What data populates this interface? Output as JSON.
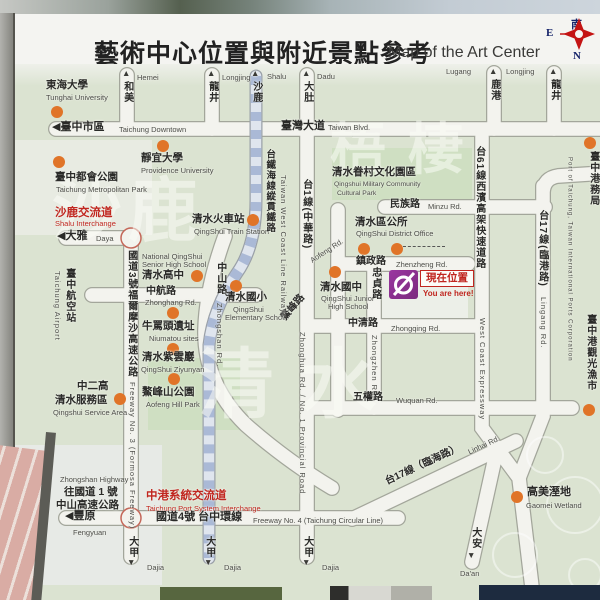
{
  "header": {
    "title_zh": "藝術中心位置與附近景點參考",
    "title_en": "Map of the Art Center"
  },
  "compass": {
    "south": "南",
    "east": "E",
    "north": "N"
  },
  "you_are_here": {
    "label_zh": "現在位置",
    "label_en": "You are here!"
  },
  "colors": {
    "map_bg": "#dbe3d1",
    "road_fill": "#f3f3ee",
    "dot_orange": "#e07428",
    "red_text": "#c0261f",
    "logo_purple": "#8e3190",
    "railway_blue": "#aab9d6"
  },
  "map": {
    "watermarks": [
      {
        "n": "watermark-shalu",
        "t": "沙鹿",
        "x": 52,
        "y": 176,
        "s": 70,
        "ls": 6
      },
      {
        "n": "watermark-wuqi",
        "t": "梧棲",
        "x": 330,
        "y": 122,
        "s": 56,
        "ls": 22
      },
      {
        "n": "watermark-qingshui",
        "t": "清水",
        "x": 198,
        "y": 348,
        "s": 76,
        "ls": 26
      }
    ],
    "dots": [
      {
        "n": "dot-tunghai-university",
        "x": 57,
        "y": 112
      },
      {
        "n": "dot-metropolitan-park",
        "x": 59,
        "y": 162
      },
      {
        "n": "dot-providence-university",
        "x": 163,
        "y": 146
      },
      {
        "n": "dot-train-station",
        "x": 253,
        "y": 220
      },
      {
        "n": "dot-qingshui-senior-high",
        "x": 197,
        "y": 276
      },
      {
        "n": "dot-qingshui-elementary",
        "x": 236,
        "y": 286
      },
      {
        "n": "dot-qingshui-junior-high",
        "x": 335,
        "y": 272
      },
      {
        "n": "dot-district-office-1",
        "x": 364,
        "y": 249
      },
      {
        "n": "dot-district-office-2",
        "x": 397,
        "y": 249
      },
      {
        "n": "dot-niumatou-sites",
        "x": 173,
        "y": 313
      },
      {
        "n": "dot-ziyunyan",
        "x": 173,
        "y": 349
      },
      {
        "n": "dot-aofeng-hill-park",
        "x": 174,
        "y": 379
      },
      {
        "n": "dot-service-area",
        "x": 120,
        "y": 399
      },
      {
        "n": "dot-gaomei-wetland",
        "x": 517,
        "y": 497
      },
      {
        "n": "dot-port-of-taichung",
        "x": 590,
        "y": 143
      },
      {
        "n": "dot-fish-market",
        "x": 589,
        "y": 410
      }
    ],
    "labels": [
      {
        "n": "arrow-hemei",
        "t": "▲",
        "x": 122,
        "y": 69,
        "k": "ar"
      },
      {
        "n": "road-hemei-zh",
        "t": "和美",
        "x": 121,
        "y": 81,
        "k": "lzh zh v",
        "s": 10
      },
      {
        "n": "road-hemei-en",
        "t": "Hemei",
        "x": 137,
        "y": 74,
        "k": "en"
      },
      {
        "n": "arrow-longjing1",
        "t": "▲",
        "x": 207,
        "y": 69,
        "k": "ar"
      },
      {
        "n": "road-longjing1-zh",
        "t": "龍井",
        "x": 206,
        "y": 81,
        "k": "zh v",
        "s": 10
      },
      {
        "n": "road-longjing1-en",
        "t": "Longjing",
        "x": 222,
        "y": 74,
        "k": "en"
      },
      {
        "n": "arrow-shalu",
        "t": "▲",
        "x": 251,
        "y": 69,
        "k": "ar"
      },
      {
        "n": "road-shalu-zh",
        "t": "沙鹿",
        "x": 250,
        "y": 81,
        "k": "zh v",
        "s": 10
      },
      {
        "n": "road-shalu-en",
        "t": "Shalu",
        "x": 267,
        "y": 73,
        "k": "en"
      },
      {
        "n": "arrow-dadu",
        "t": "▲",
        "x": 302,
        "y": 69,
        "k": "ar"
      },
      {
        "n": "road-dadu-zh",
        "t": "大肚",
        "x": 301,
        "y": 81,
        "k": "zh v",
        "s": 10
      },
      {
        "n": "road-dadu-en",
        "t": "Dadu",
        "x": 317,
        "y": 73,
        "k": "en"
      },
      {
        "n": "road-lugang-en",
        "t": "Lugang",
        "x": 446,
        "y": 68,
        "k": "en"
      },
      {
        "n": "arrow-lugang",
        "t": "▲",
        "x": 489,
        "y": 67,
        "k": "ar"
      },
      {
        "n": "road-lugang-zh",
        "t": "鹿港",
        "x": 488,
        "y": 79,
        "k": "zh v",
        "s": 10
      },
      {
        "n": "road-longjing2-en",
        "t": "Longjing",
        "x": 506,
        "y": 68,
        "k": "en"
      },
      {
        "n": "arrow-longjing2",
        "t": "▲",
        "x": 549,
        "y": 67,
        "k": "ar"
      },
      {
        "n": "road-longjing2-zh",
        "t": "龍井",
        "x": 548,
        "y": 79,
        "k": "zh v",
        "s": 10
      },
      {
        "n": "tunghai-university-zh",
        "t": "東海大學",
        "x": 46,
        "y": 80,
        "k": "zh"
      },
      {
        "n": "tunghai-university-en",
        "t": "Tunghai University",
        "x": 46,
        "y": 94,
        "k": "en"
      },
      {
        "n": "taichung-downtown-zh",
        "t": "◀臺中市區",
        "x": 52,
        "y": 122,
        "k": "zh",
        "s": 11
      },
      {
        "n": "taichung-downtown-en",
        "t": "Taichung Downtown",
        "x": 119,
        "y": 126,
        "k": "en"
      },
      {
        "n": "taiwan-blvd-zh",
        "t": "臺灣大道",
        "x": 281,
        "y": 121,
        "k": "zh",
        "s": 11
      },
      {
        "n": "taiwan-blvd-en",
        "t": "Taiwan Blvd.",
        "x": 328,
        "y": 124,
        "k": "en"
      },
      {
        "n": "providence-university-zh",
        "t": "靜宜大學",
        "x": 141,
        "y": 153,
        "k": "zh"
      },
      {
        "n": "providence-university-en",
        "t": "Providence University",
        "x": 141,
        "y": 167,
        "k": "en"
      },
      {
        "n": "metropolitan-park-zh",
        "t": "臺中都會公園",
        "x": 55,
        "y": 172,
        "k": "zh"
      },
      {
        "n": "metropolitan-park-en",
        "t": "Taichung Metropolitan Park",
        "x": 56,
        "y": 186,
        "k": "en"
      },
      {
        "n": "military-cultural-park-zh",
        "t": "清水眷村文化園區",
        "x": 332,
        "y": 167,
        "k": "zh"
      },
      {
        "n": "military-cultural-park-en1",
        "t": "Qingshui Military Community",
        "x": 334,
        "y": 181,
        "k": "en",
        "s": 6.8
      },
      {
        "n": "military-cultural-park-en2",
        "t": "Cultural Park",
        "x": 337,
        "y": 190,
        "k": "en",
        "s": 6.8
      },
      {
        "n": "shalu-interchange-zh",
        "t": "沙鹿交流道",
        "x": 55,
        "y": 207,
        "k": "zh red",
        "s": 11.5
      },
      {
        "n": "shalu-interchange-en",
        "t": "Shalu Interchange",
        "x": 55,
        "y": 220,
        "k": "en red"
      },
      {
        "n": "daya-zh",
        "t": "◀大雅",
        "x": 57,
        "y": 231,
        "k": "zh",
        "s": 11
      },
      {
        "n": "daya-en",
        "t": "Daya",
        "x": 96,
        "y": 235,
        "k": "en"
      },
      {
        "n": "train-station-zh",
        "t": "清水火車站",
        "x": 192,
        "y": 214,
        "k": "zh"
      },
      {
        "n": "train-station-en",
        "t": "QingShui Train Station",
        "x": 194,
        "y": 228,
        "k": "en"
      },
      {
        "n": "minzu-rd-zh",
        "t": "民族路",
        "x": 390,
        "y": 200,
        "k": "zh",
        "s": 10
      },
      {
        "n": "minzu-rd-en",
        "t": "Minzu Rd.",
        "x": 428,
        "y": 203,
        "k": "en"
      },
      {
        "n": "district-office-zh",
        "t": "清水區公所",
        "x": 355,
        "y": 217,
        "k": "zh"
      },
      {
        "n": "district-office-en",
        "t": "QingShui District Office",
        "x": 356,
        "y": 230,
        "k": "en"
      },
      {
        "n": "zhenzheng-rd-zh",
        "t": "鎮政路",
        "x": 356,
        "y": 257,
        "k": "zh",
        "s": 10
      },
      {
        "n": "zhenzheng-rd-en",
        "t": "Zhenzheng Rd.",
        "x": 396,
        "y": 261,
        "k": "en"
      },
      {
        "n": "senior-high-en1",
        "t": "National QingShui",
        "x": 142,
        "y": 253,
        "k": "en"
      },
      {
        "n": "senior-high-en2",
        "t": "Senior High School",
        "x": 142,
        "y": 261,
        "k": "en"
      },
      {
        "n": "senior-high-zh",
        "t": "清水高中",
        "x": 142,
        "y": 270,
        "k": "zh"
      },
      {
        "n": "zhongshan-rd-zh",
        "t": "中山路",
        "x": 214,
        "y": 262,
        "k": "zh v",
        "s": 10
      },
      {
        "n": "zhongshan-rd-en",
        "t": "Zhongshan Rd.",
        "x": 215,
        "y": 303,
        "k": "en v"
      },
      {
        "n": "zhonghang-rd-zh",
        "t": "中航路",
        "x": 146,
        "y": 287,
        "k": "zh",
        "s": 10
      },
      {
        "n": "zhonghang-rd-en",
        "t": "Zhonghang Rd.",
        "x": 145,
        "y": 299,
        "k": "en"
      },
      {
        "n": "elementary-school-zh",
        "t": "清水國小",
        "x": 225,
        "y": 292,
        "k": "zh"
      },
      {
        "n": "elementary-school-en1",
        "t": "QingShui",
        "x": 233,
        "y": 306,
        "k": "en"
      },
      {
        "n": "elementary-school-en2",
        "t": "Elementary School",
        "x": 225,
        "y": 314,
        "k": "en"
      },
      {
        "n": "aofeng-rd-zh",
        "t": "鰲峰路",
        "x": 280,
        "y": 316,
        "k": "zh",
        "s": 10,
        "r": -50
      },
      {
        "n": "aofeng-rd-en",
        "t": "Aofeng Rd.",
        "x": 309,
        "y": 258,
        "k": "en",
        "r": -33
      },
      {
        "n": "junior-high-zh",
        "t": "清水國中",
        "x": 320,
        "y": 282,
        "k": "zh"
      },
      {
        "n": "junior-high-en1",
        "t": "QingShui Junior",
        "x": 321,
        "y": 295,
        "k": "en"
      },
      {
        "n": "junior-high-en2",
        "t": "High School",
        "x": 328,
        "y": 303,
        "k": "en"
      },
      {
        "n": "zhongzhen-rd-zh",
        "t": "忠貞路",
        "x": 369,
        "y": 267,
        "k": "zh v",
        "s": 10
      },
      {
        "n": "zhongzhen-rd-en",
        "t": "Zhongzhen Rd.",
        "x": 370,
        "y": 335,
        "k": "en v"
      },
      {
        "n": "zhongqing-rd-zh",
        "t": "中清路",
        "x": 348,
        "y": 319,
        "k": "zh",
        "s": 10
      },
      {
        "n": "zhongqing-rd-en",
        "t": "Zhongqing Rd.",
        "x": 391,
        "y": 325,
        "k": "en"
      },
      {
        "n": "niumatou-zh",
        "t": "牛罵頭遺址",
        "x": 142,
        "y": 321,
        "k": "zh"
      },
      {
        "n": "niumatou-en",
        "t": "Niumatou sites",
        "x": 149,
        "y": 335,
        "k": "en"
      },
      {
        "n": "ziyunyan-zh",
        "t": "清水紫雲巖",
        "x": 142,
        "y": 352,
        "k": "zh"
      },
      {
        "n": "ziyunyan-en",
        "t": "QingShui Ziyunyan",
        "x": 141,
        "y": 366,
        "k": "en"
      },
      {
        "n": "aofeng-hill-park-zh",
        "t": "鰲峰山公園",
        "x": 142,
        "y": 387,
        "k": "zh"
      },
      {
        "n": "aofeng-hill-park-en",
        "t": "Aofeng Hill Park",
        "x": 146,
        "y": 401,
        "k": "en"
      },
      {
        "n": "service-area-zh1",
        "t": "中二高",
        "x": 77,
        "y": 381,
        "k": "zh"
      },
      {
        "n": "service-area-zh2",
        "t": "清水服務區",
        "x": 55,
        "y": 395,
        "k": "zh"
      },
      {
        "n": "service-area-en",
        "t": "Qingshui Service Area",
        "x": 53,
        "y": 409,
        "k": "en"
      },
      {
        "n": "wuquan-rd-zh",
        "t": "五權路",
        "x": 353,
        "y": 393,
        "k": "zh",
        "s": 10
      },
      {
        "n": "wuquan-rd-en",
        "t": "Wuquan Rd.",
        "x": 396,
        "y": 397,
        "k": "en"
      },
      {
        "n": "airport-zh",
        "t": "臺中航空站",
        "x": 63,
        "y": 268,
        "k": "zh v",
        "s": 10
      },
      {
        "n": "airport-en",
        "t": "Taichung Airport",
        "x": 53,
        "y": 271,
        "k": "en v"
      },
      {
        "n": "freeway3-zh",
        "t": "國道3號福爾摩沙高速公路",
        "x": 125,
        "y": 250,
        "k": "zh v",
        "s": 10
      },
      {
        "n": "freeway3-en",
        "t": "Freeway No. 3 (Formosa Freeway)",
        "x": 128,
        "y": 382,
        "k": "en v",
        "h": 130
      },
      {
        "n": "provincial1-zh",
        "t": "台1線(中華路)",
        "x": 300,
        "y": 179,
        "k": "zh v",
        "s": 10
      },
      {
        "n": "provincial1-en",
        "t": "Zhonghua Rd. / No. 1 Provincial Road",
        "x": 298,
        "y": 332,
        "k": "en v",
        "h": 100
      },
      {
        "n": "railway-zh",
        "t": "台鐵海線縱貫鐵路",
        "x": 264,
        "y": 149,
        "k": "zh v",
        "s": 9.5
      },
      {
        "n": "railway-en",
        "t": "Taiwan West Coast Line Railways",
        "x": 279,
        "y": 175,
        "k": "en v",
        "h": 95
      },
      {
        "n": "expressway61-zh",
        "t": "台61線西濱高架快速道路",
        "x": 473,
        "y": 146,
        "k": "zh v",
        "s": 10
      },
      {
        "n": "expressway61-en",
        "t": "West Coast Expressway",
        "x": 478,
        "y": 318,
        "k": "en v",
        "h": 85
      },
      {
        "n": "provincial17-lingang-zh",
        "t": "台17線(臨港路)",
        "x": 536,
        "y": 210,
        "k": "zh v",
        "s": 10
      },
      {
        "n": "provincial17-lingang-en",
        "t": "Lingang Rd.",
        "x": 539,
        "y": 297,
        "k": "en v"
      },
      {
        "n": "provincial17-linhai-zh",
        "t": "台17線（臨海路）",
        "x": 384,
        "y": 478,
        "k": "zh",
        "s": 10,
        "r": -25
      },
      {
        "n": "provincial17-linhai-en",
        "t": "Linhai Rd.",
        "x": 467,
        "y": 449,
        "k": "en",
        "r": -25
      },
      {
        "n": "port-of-taichung-zh",
        "t": "臺中港務局",
        "x": 587,
        "y": 151,
        "k": "zh v",
        "s": 10
      },
      {
        "n": "port-of-taichung-en",
        "t": "Port of Taichung, Taiwan International Ports Corporation",
        "x": 566,
        "y": 157,
        "k": "en v",
        "s": 6,
        "h": 155
      },
      {
        "n": "fish-market-zh",
        "t": "臺中港觀光漁市",
        "x": 584,
        "y": 314,
        "k": "zh v",
        "s": 10
      },
      {
        "n": "gaomei-wetland-zh",
        "t": "高美溼地",
        "x": 527,
        "y": 487,
        "k": "zh",
        "s": 11
      },
      {
        "n": "gaomei-wetland-en",
        "t": "Gaomei Wetland",
        "x": 526,
        "y": 502,
        "k": "en"
      },
      {
        "n": "zhongshan-highway-en",
        "t": "Zhongshan Highway",
        "x": 60,
        "y": 476,
        "k": "en"
      },
      {
        "n": "to-freeway1-zh",
        "t": "往國道 1 號",
        "x": 64,
        "y": 487,
        "k": "zh",
        "s": 10.5
      },
      {
        "n": "zhongshan-highway-zh",
        "t": "中山高速公路",
        "x": 56,
        "y": 500,
        "k": "zh",
        "s": 10.5
      },
      {
        "n": "port-system-interchange-zh",
        "t": "中港系統交流道",
        "x": 146,
        "y": 490,
        "k": "zh red",
        "s": 11.5
      },
      {
        "n": "port-system-interchange-en",
        "t": "Taichung Port System Interchange",
        "x": 146,
        "y": 505,
        "k": "en red"
      },
      {
        "n": "fengyuan-zh",
        "t": "◀豐原",
        "x": 65,
        "y": 511,
        "k": "zh",
        "s": 11
      },
      {
        "n": "fengyuan-en",
        "t": "Fengyuan",
        "x": 73,
        "y": 529,
        "k": "en"
      },
      {
        "n": "freeway4-zh",
        "t": "國道4號 台中環線",
        "x": 156,
        "y": 512,
        "k": "zh",
        "s": 11
      },
      {
        "n": "freeway4-en",
        "t": "Freeway No. 4 (Taichung Circular Line)",
        "x": 253,
        "y": 517,
        "k": "en"
      },
      {
        "n": "dajia1-zh",
        "t": "大甲",
        "x": 126,
        "y": 536,
        "k": "zh v",
        "s": 10
      },
      {
        "n": "arrow-dajia1",
        "t": "▼",
        "x": 127,
        "y": 558,
        "k": "ar"
      },
      {
        "n": "dajia1-en",
        "t": "Dajia",
        "x": 147,
        "y": 564,
        "k": "en"
      },
      {
        "n": "dajia2-zh",
        "t": "大甲",
        "x": 203,
        "y": 536,
        "k": "zh v",
        "s": 10
      },
      {
        "n": "arrow-dajia2",
        "t": "▼",
        "x": 204,
        "y": 558,
        "k": "ar"
      },
      {
        "n": "dajia2-en",
        "t": "Dajia",
        "x": 224,
        "y": 564,
        "k": "en"
      },
      {
        "n": "dajia3-zh",
        "t": "大甲",
        "x": 301,
        "y": 536,
        "k": "zh v",
        "s": 10
      },
      {
        "n": "arrow-dajia3",
        "t": "▼",
        "x": 302,
        "y": 558,
        "k": "ar"
      },
      {
        "n": "dajia3-en",
        "t": "Dajia",
        "x": 322,
        "y": 564,
        "k": "en"
      },
      {
        "n": "daan-zh",
        "t": "大安",
        "x": 469,
        "y": 527,
        "k": "zh v",
        "s": 10
      },
      {
        "n": "arrow-daan",
        "t": "▼",
        "x": 467,
        "y": 551,
        "k": "ar"
      },
      {
        "n": "daan-en",
        "t": "Da'an",
        "x": 460,
        "y": 570,
        "k": "en"
      }
    ]
  }
}
